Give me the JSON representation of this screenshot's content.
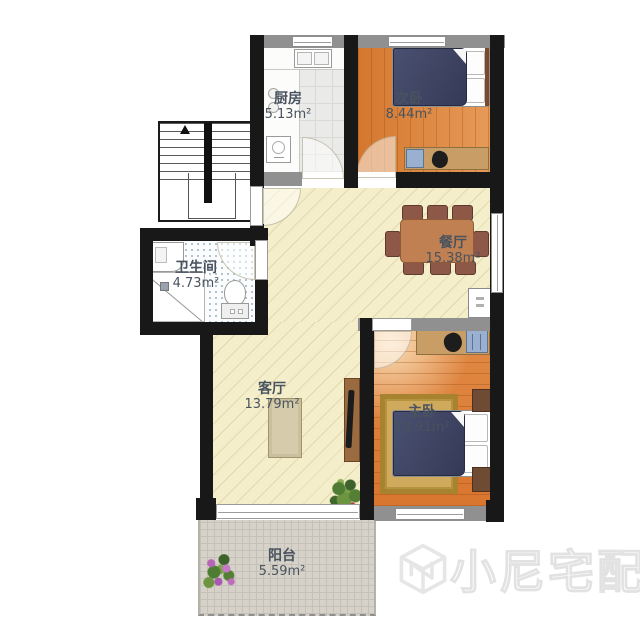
{
  "meta": {
    "type": "apartment-floorplan"
  },
  "rooms": [
    {
      "key": "kitchen",
      "name": "厨房",
      "area": "5.13m²"
    },
    {
      "key": "second-bedroom",
      "name": "次卧",
      "area": "8.44m²"
    },
    {
      "key": "dining-room",
      "name": "餐厅",
      "area": "15.38m²"
    },
    {
      "key": "bathroom",
      "name": "卫生间",
      "area": "4.73m²"
    },
    {
      "key": "living-room",
      "name": "客厅",
      "area": "13.79m²"
    },
    {
      "key": "master-bedroom",
      "name": "主卧",
      "area": "10.91m²"
    },
    {
      "key": "balcony",
      "name": "阳台",
      "area": "5.59m²"
    }
  ],
  "watermark": {
    "brand": "小尼宅配"
  },
  "colors": {
    "wall": "#181818",
    "wall_light": "#909090",
    "floor_main": "#f4eecb",
    "floor_wood": "#dd8040",
    "floor_kitchen": "#eaeae8",
    "floor_balcony": "#d6d2c9",
    "bed_duvet": "#3a4060",
    "rug": "#c9a253",
    "sofa": "#f3eed2",
    "dining_table": "#c08052"
  }
}
